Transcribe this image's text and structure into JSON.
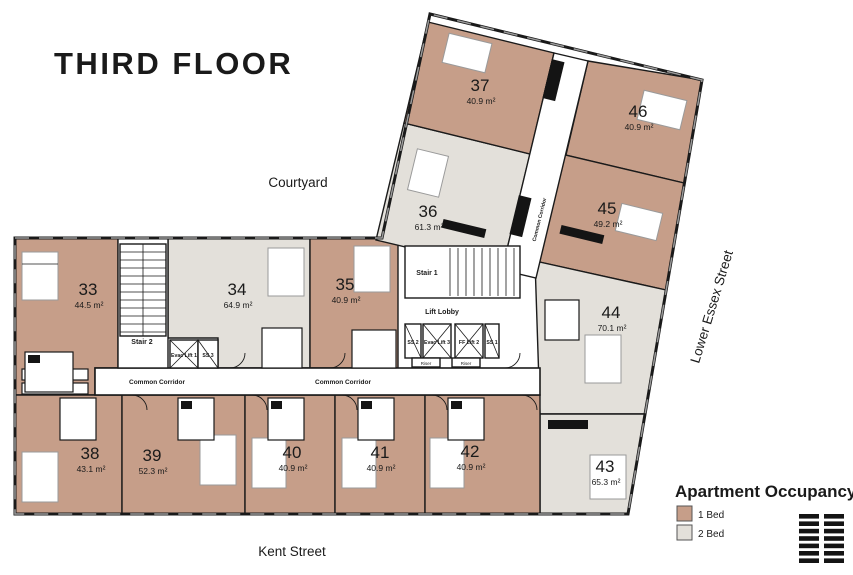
{
  "title": "THIRD FLOOR",
  "streets": {
    "courtyard": "Courtyard",
    "kent": "Kent Street",
    "lower_essex": "Lower Essex Street"
  },
  "legend": {
    "title": "Apartment Occupancy",
    "items": [
      {
        "label": "1 Bed",
        "color": "#c69e89"
      },
      {
        "label": "2 Bed",
        "color": "#e3e0da"
      }
    ]
  },
  "apartments": [
    {
      "number": "33",
      "area": "44.5 m²",
      "occupancy": "1 Bed"
    },
    {
      "number": "34",
      "area": "64.9 m²",
      "occupancy": "2 Bed"
    },
    {
      "number": "35",
      "area": "40.9 m²",
      "occupancy": "1 Bed"
    },
    {
      "number": "36",
      "area": "61.3 m²",
      "occupancy": "2 Bed"
    },
    {
      "number": "37",
      "area": "40.9 m²",
      "occupancy": "1 Bed"
    },
    {
      "number": "38",
      "area": "43.1 m²",
      "occupancy": "1 Bed"
    },
    {
      "number": "39",
      "area": "52.3 m²",
      "occupancy": "1 Bed"
    },
    {
      "number": "40",
      "area": "40.9 m²",
      "occupancy": "1 Bed"
    },
    {
      "number": "41",
      "area": "40.9 m²",
      "occupancy": "1 Bed"
    },
    {
      "number": "42",
      "area": "40.9 m²",
      "occupancy": "1 Bed"
    },
    {
      "number": "43",
      "area": "65.3 m²",
      "occupancy": "2 Bed"
    },
    {
      "number": "44",
      "area": "70.1 m²",
      "occupancy": "2 Bed"
    },
    {
      "number": "45",
      "area": "49.2 m²",
      "occupancy": "1 Bed"
    },
    {
      "number": "46",
      "area": "40.9 m²",
      "occupancy": "1 Bed"
    }
  ],
  "cores": {
    "stair_1": "Stair 1",
    "stair_2": "Stair 2",
    "lift_lobby": "Lift Lobby",
    "evac_lift_1": "Evac Lift 1",
    "evac_lift_3": "Evac Lift 3",
    "ff_lift_2": "FF Lift 2",
    "ss_1": "SS 1",
    "ss_2": "SS 2",
    "ss_3": "SS 3",
    "riser": "Riser",
    "common_corridor": "Common Corridor"
  }
}
